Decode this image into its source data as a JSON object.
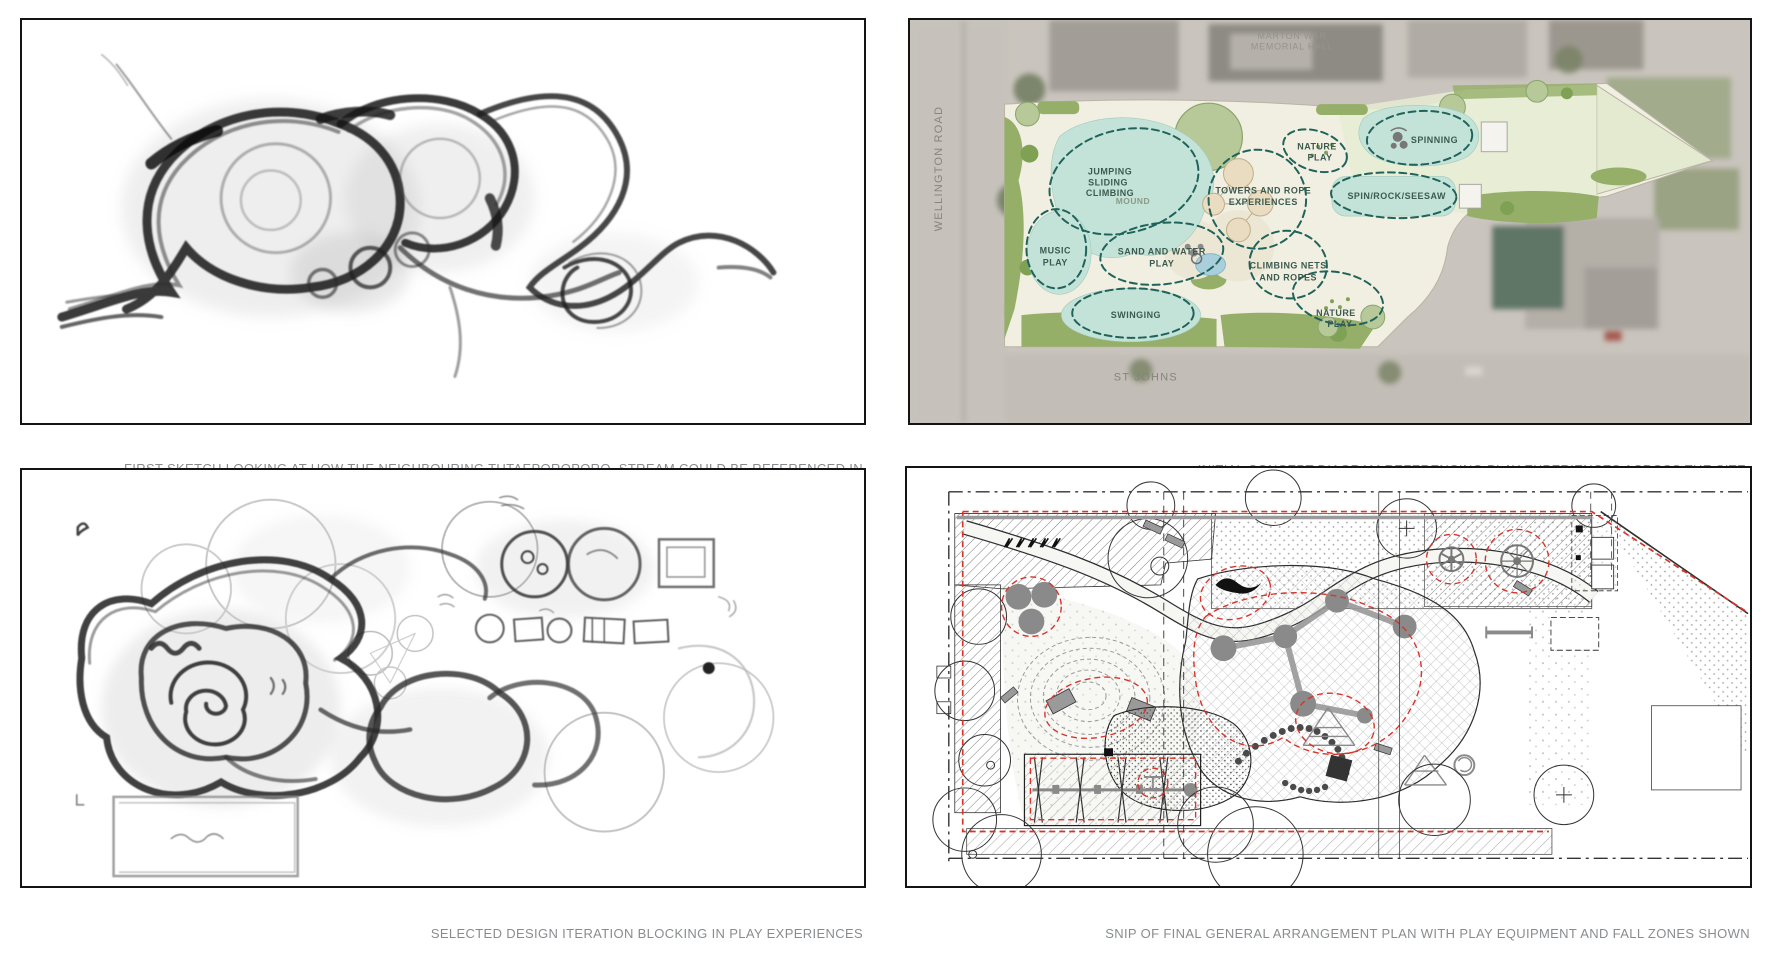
{
  "theme": {
    "page-bg": "#ffffff",
    "panel-border": "#141414",
    "caption-color": "#898c8f",
    "concept-dash": "#20635a",
    "concept-label": "#3c5a50",
    "street-label": "#84867b",
    "hall-label": "#97938b",
    "mound-label": "#8a9a86",
    "fall-red": "#d8342a",
    "teal-fill": "#c4e3d8",
    "park-cream": "#f1eee2",
    "planting-green": "#95ae68"
  },
  "captions": {
    "first_sketch_line1": "FIRST SKETCH LOOKING AT HOW THE NEIGHBOURING TUTAEPOROPORO  STREAM COULD BE REFERENCED IN",
    "first_sketch_line2": "CIRCULATION AND FLOW OF PEOPLE",
    "concept": "INITIAL CONCEPT DIAGRAM REFERENCING PLAY EXPERIENCES ACROSS THE SITE",
    "iteration": "SELECTED DESIGN ITERATION BLOCKING IN PLAY EXPERIENCES",
    "final_plan": "SNIP OF FINAL GENERAL ARRANGEMENT PLAN WITH PLAY EQUIPMENT AND FALL ZONES SHOWN"
  },
  "concept": {
    "context": {
      "hall_l1": "MARTON WAR",
      "hall_l2": "MEMORIAL HALL",
      "road_west": "WELLINGTON ROAD",
      "road_south": "ST JOHNS"
    },
    "zones": {
      "jumping_l1": "JUMPING",
      "jumping_l2": "SLIDING",
      "jumping_l3": "CLIMBING",
      "mound": "MOUND",
      "music_l1": "MUSIC",
      "music_l2": "PLAY",
      "sand_l1": "SAND AND WATER",
      "sand_l2": "PLAY",
      "swinging": "SWINGING",
      "towers_l1": "TOWERS AND ROPE",
      "towers_l2": "EXPERIENCES",
      "nature_upper_l1": "NATURE",
      "nature_upper_l2": "PLAY",
      "spinning": "SPINNING",
      "spin_rock": "SPIN/ROCK/SEESAW",
      "nets_l1": "CLIMBING NETS",
      "nets_l2": "AND ROPES",
      "nature_lower_l1": "NATURE",
      "nature_lower_l2": "PLAY"
    }
  }
}
